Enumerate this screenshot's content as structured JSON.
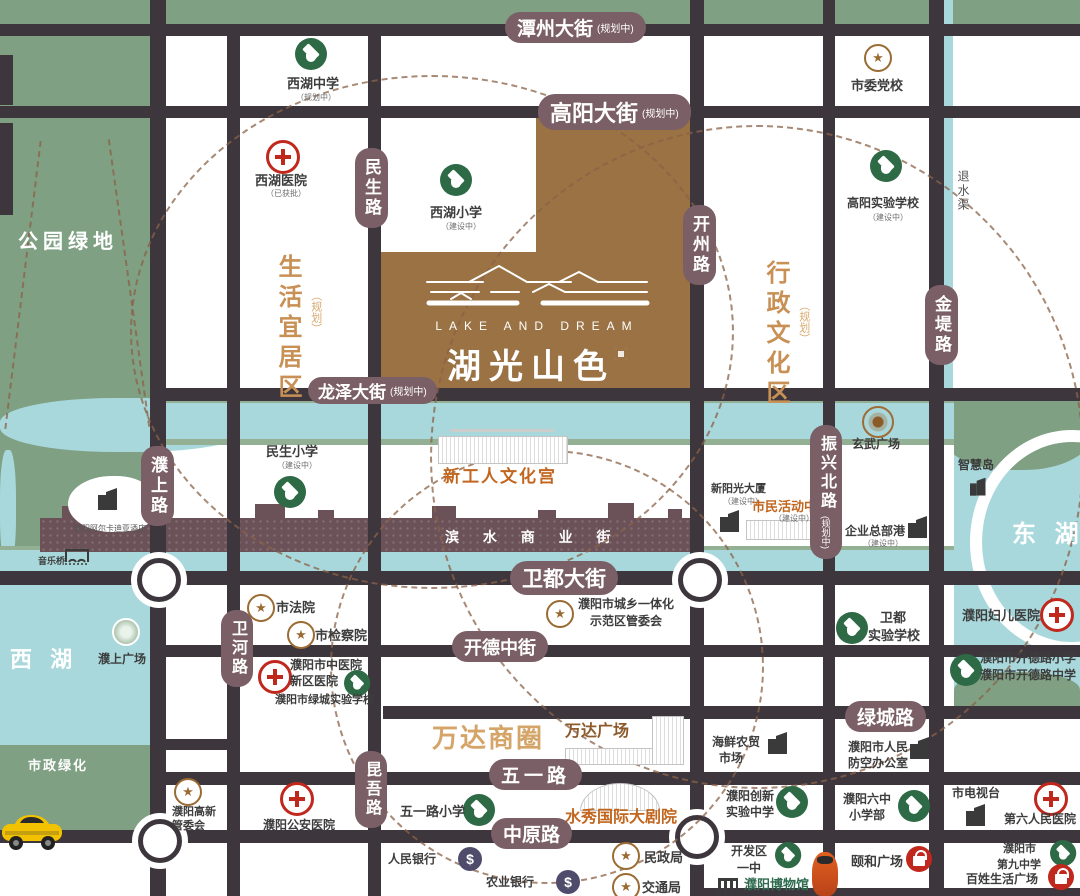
{
  "project": {
    "en": "LAKE  AND  DREAM",
    "cn": "湖光山色"
  },
  "areas": {
    "park": "公园绿地",
    "municipal_green": "市政绿化",
    "west_lake": "西 湖",
    "east_lake": "东 湖",
    "drain": "退水渠",
    "wanda_circle": "万达商圈",
    "living": {
      "name": "生活宜居区",
      "tag": "（规划）"
    },
    "admin": {
      "name": "行政文化区",
      "tag": "（规划）"
    }
  },
  "streets": {
    "tanzhou": {
      "name": "潭州大街",
      "tag": "(规划中)"
    },
    "gaoyang": {
      "name": "高阳大街",
      "tag": "(规划中)"
    },
    "longze": {
      "name": "龙泽大街",
      "tag": "(规划中)"
    },
    "weidu": {
      "name": "卫都大街"
    },
    "kaide": {
      "name": "开德中街"
    },
    "lvcheng": {
      "name": "绿城路"
    },
    "wuyi": {
      "name": "五一路"
    },
    "zhongyuan": {
      "name": "中原路"
    },
    "minsheng": {
      "name": "民生路"
    },
    "kaizhou": {
      "name": "开州路"
    },
    "jindi": {
      "name": "金堤路"
    },
    "pushang": {
      "name": "濮上路"
    },
    "weihe": {
      "name": "卫河路"
    },
    "kunwu": {
      "name": "昆吾路"
    },
    "zhenxing": {
      "name": "振兴北路",
      "tag": "(规划中)"
    }
  },
  "pois": {
    "xihu_middle": {
      "label": "西湖中学",
      "sub": "（规划中）"
    },
    "shiwei_dangxiao": {
      "label": "市委党校"
    },
    "xihu_hospital": {
      "label": "西湖医院",
      "sub": "（已获批）"
    },
    "xihu_primary": {
      "label": "西湖小学",
      "sub": "（建设中）"
    },
    "gaoyang_school": {
      "label": "高阳实验学校",
      "sub": "（建设中）"
    },
    "minsheng_primary": {
      "label": "民生小学",
      "sub": "（建设中）"
    },
    "wenhuagong": {
      "label": "新工人文化宫"
    },
    "binshui": {
      "label": "滨 水 商 业 街"
    },
    "xuanwu": {
      "label": "玄武广场"
    },
    "xinyangguang": {
      "label": "新阳光大厦",
      "sub": "（建设中）"
    },
    "shimin_center": {
      "label": "市民活动中心",
      "sub": "（建设中）"
    },
    "qiye_port": {
      "label": "企业总部港",
      "sub": "（建设中）"
    },
    "zhihuidao": {
      "label": "智慧岛"
    },
    "hotel": {
      "label": "濮阳阿尔卡迪亚酒店"
    },
    "yinyueqiao": {
      "label": "音乐桥"
    },
    "pushang_square": {
      "label": "濮上广场"
    },
    "shifayuan": {
      "label": "市法院"
    },
    "jianchayuan": {
      "label": "市检察院"
    },
    "guanweihui": {
      "l1": "濮阳市城乡一体化",
      "l2": "示范区管委会"
    },
    "zhongyi": {
      "l1": "濮阳市中医院",
      "l2": "新区医院"
    },
    "lvcheng_school": {
      "label": "濮阳市绿城实验学校"
    },
    "weidu_school": {
      "l1": "卫都",
      "l2": "实验学校"
    },
    "fuer": {
      "label": "濮阳妇儿医院"
    },
    "kaidelu": {
      "l1": "濮阳市开德路小学",
      "l2": "濮阳市开德路中学"
    },
    "wanda_plaza": {
      "label": "万达广场"
    },
    "haixian": {
      "l1": "海鲜农贸",
      "l2": "市场"
    },
    "renfang": {
      "l1": "濮阳市人民",
      "l2": "防空办公室"
    },
    "gaoxin": {
      "l1": "濮阳高新",
      "l2": "管委会"
    },
    "gongan": {
      "label": "濮阳公安医院"
    },
    "wuyilu_primary": {
      "label": "五一路小学"
    },
    "shuixiu": {
      "label": "水秀国际大剧院"
    },
    "chuangxin": {
      "l1": "濮阳创新",
      "l2": "实验中学"
    },
    "liuzhong": {
      "l1": "濮阳六中",
      "l2": "小学部"
    },
    "tv": {
      "label": "市电视台"
    },
    "diliu": {
      "label": "第六人民医院"
    },
    "renmin_bank": {
      "label": "人民银行"
    },
    "nongye_bank": {
      "label": "农业银行"
    },
    "minzheng": {
      "label": "民政局"
    },
    "jiaotong": {
      "label": "交通局"
    },
    "kaifaqu": {
      "l1": "开发区",
      "l2": "一中"
    },
    "museum": {
      "label": "濮阳博物馆"
    },
    "yihe": {
      "label": "颐和广场"
    },
    "jiuzhong": {
      "l1": "濮阳市",
      "l2": "第九中学"
    },
    "baixing": {
      "label": "百姓生活广场"
    }
  },
  "icons": {
    "bank_symbol": "$",
    "star_symbol": "★"
  },
  "colors": {
    "road": "#3E363D",
    "park_green": "#7FA083",
    "water": "#A8D8DB",
    "project_brown": "#9A7243",
    "pill_mauve": "#7A5F66",
    "poi_orange": "#C2661F",
    "district_tan": "#C89055",
    "school_green": "#2D6A45",
    "hospital_red": "#C0281E",
    "star_brown": "#9A6B33",
    "bank_purple": "#4E4B6B",
    "skyline_mauve": "#6B5158"
  }
}
